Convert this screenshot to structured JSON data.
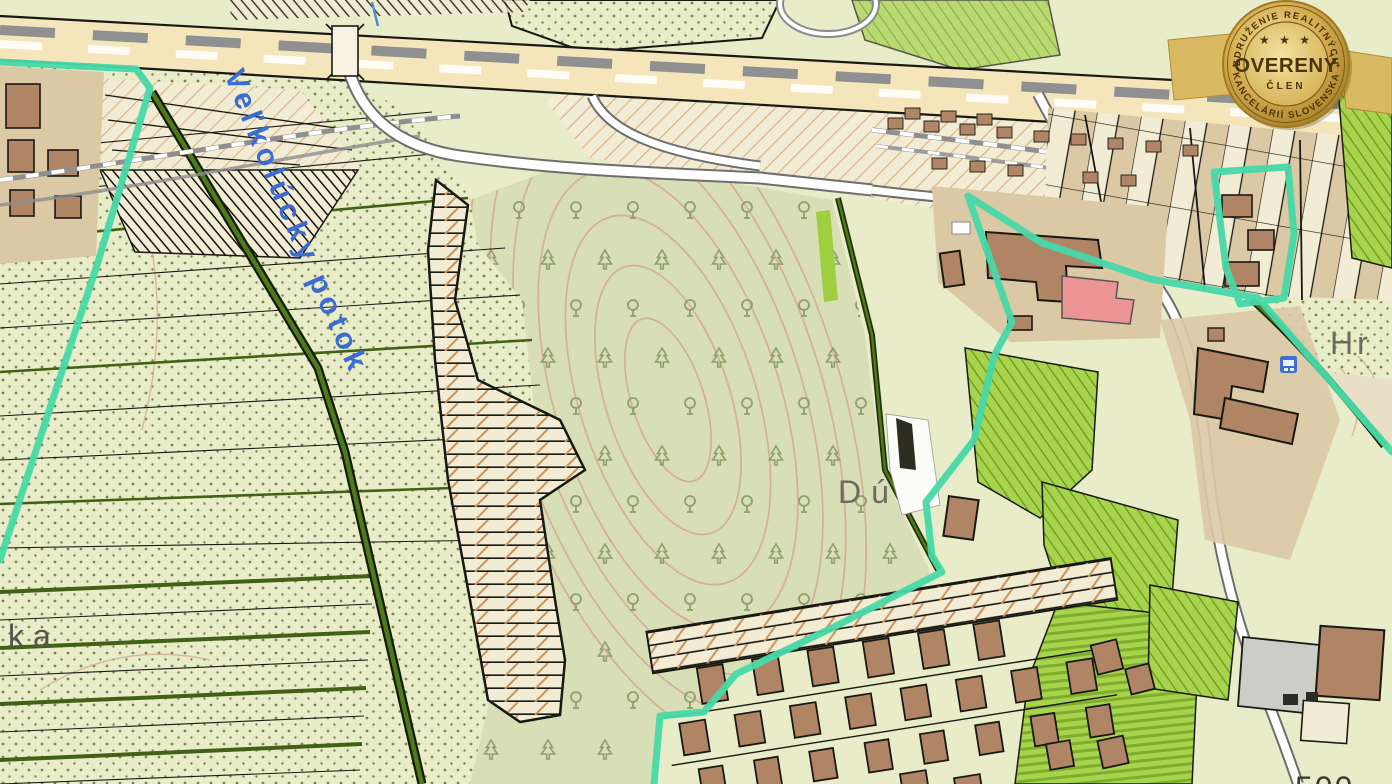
{
  "map": {
    "alt": "Cadastral topographic map with highlighted property boundary",
    "labels": {
      "stream": "Veľkolúcky potok",
      "place_partial_du": "Dú",
      "place_partial_hr": "Hr",
      "place_partial_ka": "ka",
      "parcel_number": "500"
    },
    "colors": {
      "base": "#e9ecc8",
      "forest": "#d8deb5",
      "dot": "#76864e",
      "contour": "#d4ae95",
      "road_fill": "#f4e6ba",
      "road_casing": "#6e6e6e",
      "rail_gray": "#8f8f8f",
      "rail_beige": "#e8d9ab",
      "boundary": "#47d9a9",
      "parcel_line": "#191913",
      "field_green": "#416114",
      "orchard": "#a7d34d",
      "orchard_line": "#67941f",
      "building": "#b08566",
      "building_red": "#ec9393",
      "tan": "#dbc9a6",
      "cream": "#f2ecd4",
      "hatch": "#c9935f",
      "tree": "#8fa06b",
      "stream_text": "#3b6cd2",
      "gray_text": "#6b6b60",
      "gray_area": "#cdcdc8",
      "bus_blue": "#3e6fd1"
    }
  },
  "badge": {
    "arc_top": "ZDRUŽENIE REALITNÝCH",
    "title": "OVERENÝ",
    "subtitle": "ČLEN",
    "arc_bottom": "KANCELÁRIÍ SLOVENSKA",
    "stars": "★ ★ ★",
    "separator": "✦",
    "colors": {
      "gold_light": "#f6e5a3",
      "gold": "#d4ab4e",
      "gold_dark": "#9f7a22",
      "text_brown": "#4b3408",
      "ribbon": "#d9ba62"
    }
  }
}
